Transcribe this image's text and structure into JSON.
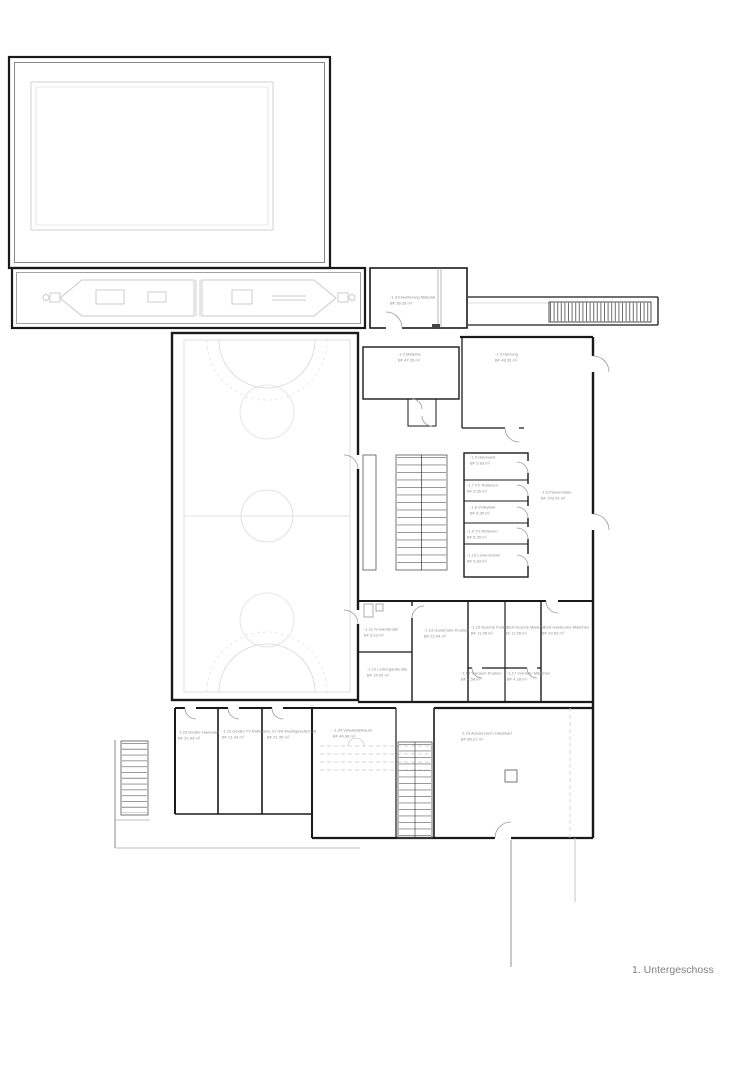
{
  "plan": {
    "floor_label": "1. Untergeschoss"
  },
  "colors": {
    "background": "#ffffff",
    "exterior_wall": "#1a1a1a",
    "partition_wall": "#3a3a3a",
    "court_lines": "#d8d8d8",
    "door_swing": "#9a9a9a",
    "label_text": "#8b8b8b",
    "title_text": "#7f7f7f"
  },
  "rooms": [
    {
      "label": "-1.2 Material",
      "area": "BF 47.26 m²"
    },
    {
      "label": "-1.3 Erweiterung Material",
      "area": "BF 36.28 m²"
    },
    {
      "label": "-1.4 Heizung",
      "area": "BF 48.33 m²"
    },
    {
      "label": "-1.5 Pausenhalle",
      "area": "BF 143.41 m²"
    },
    {
      "label": "-1.6 Hauswart",
      "area": "BF 5.83 m²"
    },
    {
      "label": "-1.7 FC Rüttenen",
      "area": "BF 5.26 m²"
    },
    {
      "label": "-1.8 Volleyball",
      "area": "BF 5.35 m²"
    },
    {
      "label": "-1.9 TV Rüttenen",
      "area": "BF 5.35 m²"
    },
    {
      "label": "-1.10 Lehrerschaft",
      "area": "BF 5.83 m²"
    },
    {
      "label": "-1.11 IV-Garderobe",
      "area": "BF 5.13 m²"
    },
    {
      "label": "-1.12 Lehrergarderobe",
      "area": "BF 14.05 m²"
    },
    {
      "label": "-1.13 Garderobe Knaben",
      "area": "BF 22.04 m²"
    },
    {
      "label": "-1.14 Vorraum Knaben",
      "area": "BF 4.58 m²"
    },
    {
      "label": "-1.15 Dusche Knaben",
      "area": "BF 11.05 m²"
    },
    {
      "label": "-1.16 Dusche Mädchen",
      "area": "BF 11.05 m²"
    },
    {
      "label": "-1.17 Vorraum Mädchen",
      "area": "BF 4.28 m²"
    },
    {
      "label": "-1.18 Garderobe Mädchen",
      "area": "BF 20.53 m²"
    },
    {
      "label": "-1.19 Aussenraum Hauswart",
      "area": "BF 88.21 m²"
    },
    {
      "label": "-1.20 Veloabstellraum",
      "area": "BF 44.36 m²"
    },
    {
      "label": "-1.21 GR Musikgesellschaft",
      "area": "BF 21.45 m²"
    },
    {
      "label": "-1.22 Geräte TV Rüttenen",
      "area": "BF 21.43 m²"
    },
    {
      "label": "-1.23 Geräte Hauswart",
      "area": "BF 21.44 m²"
    }
  ]
}
